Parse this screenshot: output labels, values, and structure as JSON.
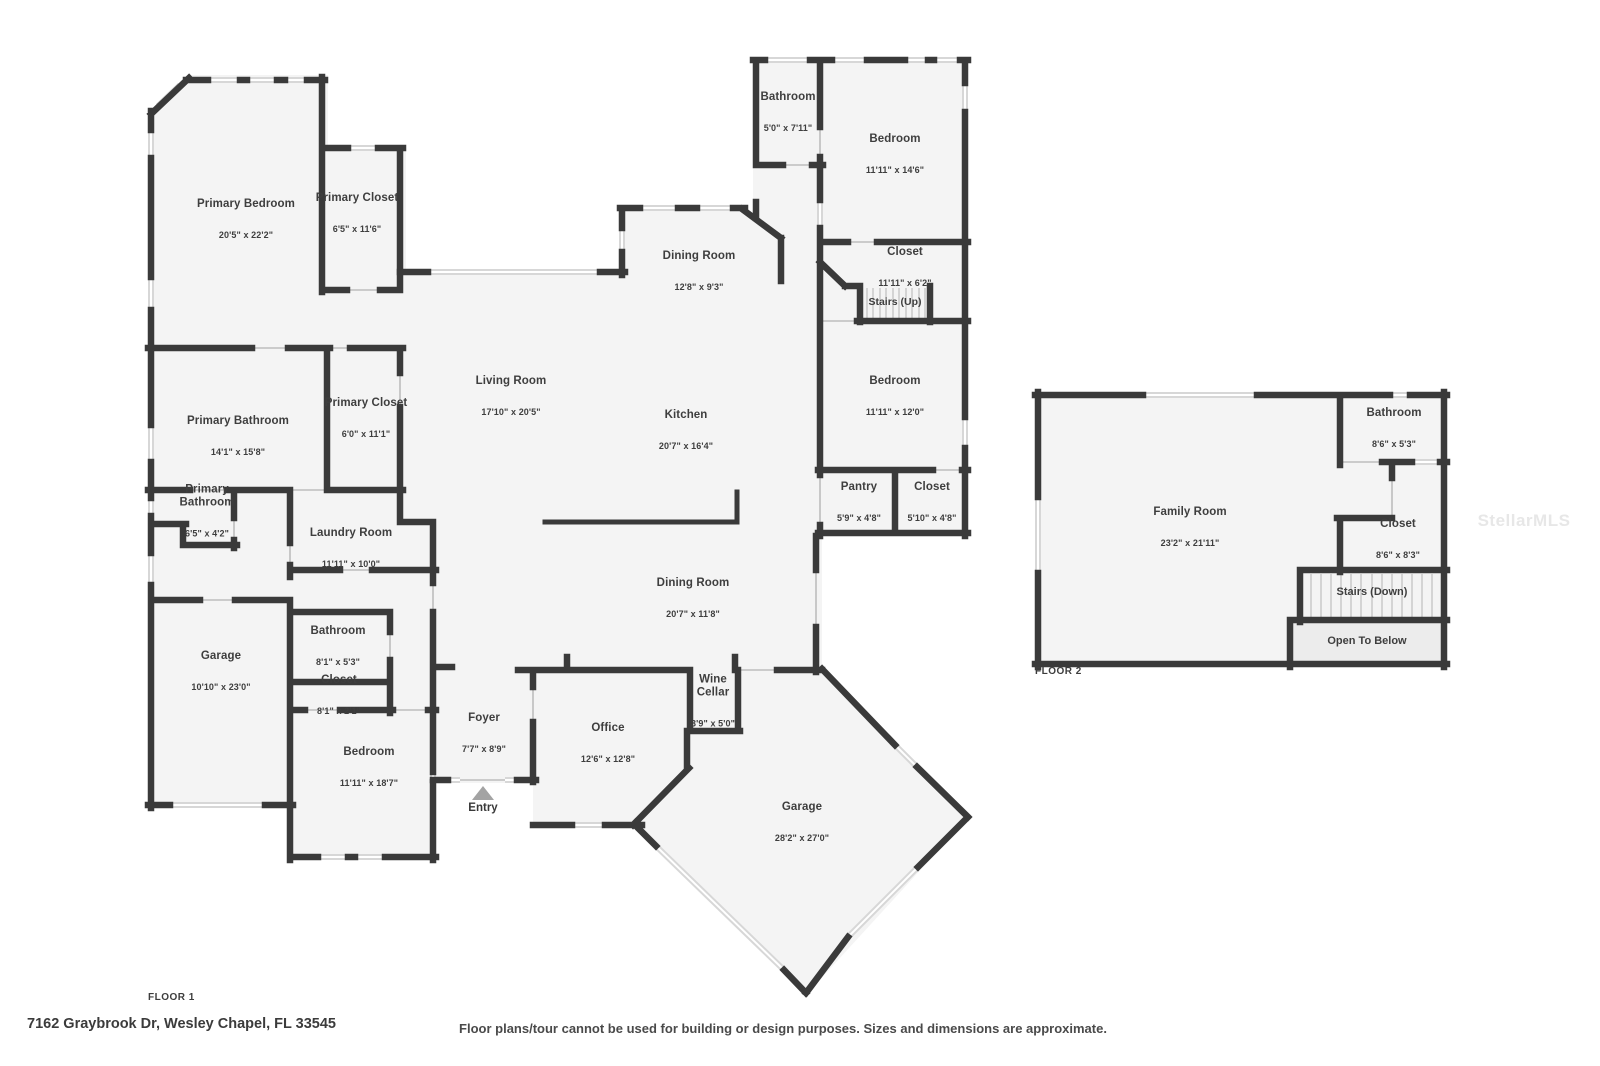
{
  "palette": {
    "wall_color": "#3a3a3a",
    "room_fill": "#f4f4f4",
    "window_fill": "#d7d7d7",
    "open_to_below_fill": "#ececec",
    "text_color": "#3e3e3e"
  },
  "floor1": {
    "label": "FLOOR 1",
    "entry": {
      "label": "Entry"
    },
    "stairs": {
      "label": "Stairs (Up)"
    },
    "rooms": [
      {
        "name": "Primary Bedroom",
        "dims": "20'5\" x 22'2\""
      },
      {
        "name": "Primary Closet",
        "dims": "6'5\" x 11'6\""
      },
      {
        "name": "Bathroom",
        "dims": "5'0\" x 7'11\""
      },
      {
        "name": "Bedroom",
        "dims": "11'11\" x 14'6\""
      },
      {
        "name": "Dining Room",
        "dims": "12'8\" x 9'3\""
      },
      {
        "name": "Closet",
        "dims": "11'11\" x 6'2\""
      },
      {
        "name": "Living Room",
        "dims": "17'10\" x 20'5\""
      },
      {
        "name": "Kitchen",
        "dims": "20'7\" x 16'4\""
      },
      {
        "name": "Bedroom",
        "dims": "11'11\" x 12'0\""
      },
      {
        "name": "Primary Bathroom",
        "dims": "14'1\" x 15'8\""
      },
      {
        "name": "Primary Closet",
        "dims": "6'0\" x 11'1\""
      },
      {
        "name": "Primary\nBathroom",
        "dims": "6'5\" x 4'2\""
      },
      {
        "name": "Laundry Room",
        "dims": "11'11\" x 10'0\""
      },
      {
        "name": "Pantry",
        "dims": "5'9\" x 4'8\""
      },
      {
        "name": "Closet",
        "dims": "5'10\" x 4'8\""
      },
      {
        "name": "Dining Room",
        "dims": "20'7\" x 11'8\""
      },
      {
        "name": "Garage",
        "dims": "10'10\" x 23'0\""
      },
      {
        "name": "Bathroom",
        "dims": "8'1\" x 5'3\""
      },
      {
        "name": "Closet",
        "dims": "8'1\" x 2'1\""
      },
      {
        "name": "Bedroom",
        "dims": "11'11\" x 18'7\""
      },
      {
        "name": "Foyer",
        "dims": "7'7\" x 8'9\""
      },
      {
        "name": "Office",
        "dims": "12'6\" x 12'8\""
      },
      {
        "name": "Wine\nCellar",
        "dims": "3'9\" x 5'0\""
      },
      {
        "name": "Garage",
        "dims": "28'2\" x 27'0\""
      }
    ]
  },
  "floor2": {
    "label": "FLOOR 2",
    "stairs": {
      "label": "Stairs (Down)"
    },
    "open_to_below": {
      "label": "Open To Below"
    },
    "rooms": [
      {
        "name": "Family Room",
        "dims": "23'2\" x 21'11\""
      },
      {
        "name": "Bathroom",
        "dims": "8'6\" x 5'3\""
      },
      {
        "name": "Closet",
        "dims": "8'6\" x 8'3\""
      }
    ]
  },
  "footer": {
    "address": "7162 Graybrook Dr, Wesley Chapel, FL 33545",
    "disclaimer": "Floor plans/tour cannot be used for building or design purposes. Sizes and dimensions are approximate."
  },
  "watermark": "StellarMLS"
}
